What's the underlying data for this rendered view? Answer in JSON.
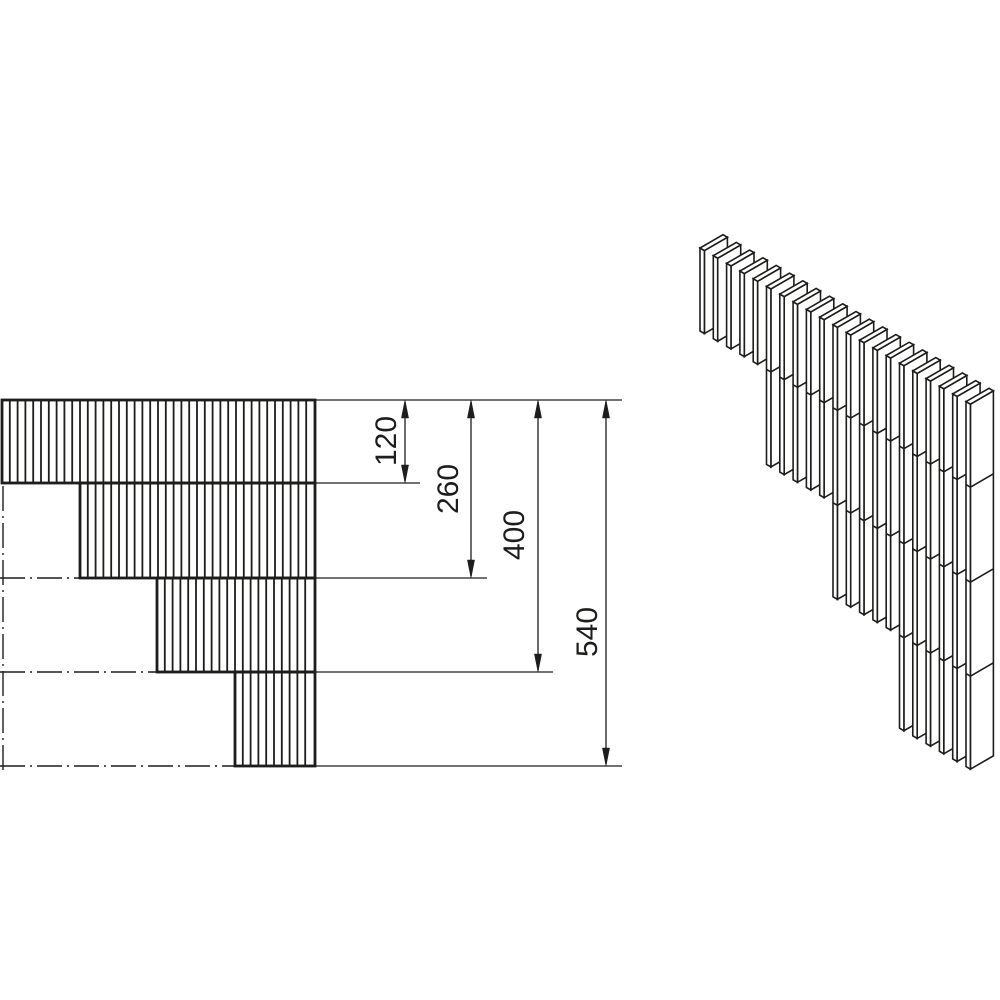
{
  "page": {
    "background": "#ffffff"
  },
  "drawing": {
    "type": "technical-drawing-stepped-lamella-corner",
    "stroke_color": "#1d1d1b",
    "fill_color": "#ffffff",
    "dimensions": {
      "labels": [
        "120",
        "260",
        "400",
        "540"
      ],
      "values": [
        120,
        260,
        400,
        540
      ],
      "font_size": 30,
      "lines": [
        {
          "x": 405,
          "y1": 400,
          "y2": 483,
          "label_x": 388,
          "label_y": 441
        },
        {
          "x": 471,
          "y1": 400,
          "y2": 578,
          "label_x": 450,
          "label_y": 489
        },
        {
          "x": 538,
          "y1": 400,
          "y2": 672,
          "label_x": 516,
          "label_y": 535
        },
        {
          "x": 606,
          "y1": 400,
          "y2": 766,
          "label_x": 589,
          "label_y": 632
        }
      ],
      "extension_lines": [
        [
          316,
          400,
          622,
          400
        ],
        [
          316,
          483,
          420,
          483
        ],
        [
          316,
          578,
          487,
          578
        ],
        [
          316,
          672,
          553,
          672
        ],
        [
          316,
          766,
          622,
          766
        ]
      ],
      "arrow_length": 18,
      "arrow_half_width": 3.6
    },
    "front_view": {
      "bands": [
        {
          "x": 2,
          "y": 400,
          "w": 313,
          "h": 83
        },
        {
          "x": 80,
          "y": 483,
          "w": 235,
          "h": 95
        },
        {
          "x": 157,
          "y": 578,
          "w": 158,
          "h": 94
        },
        {
          "x": 235,
          "y": 672,
          "w": 80,
          "h": 94
        }
      ],
      "hatch_spacing": 7.8,
      "hatch_width": 1.8,
      "border_width": 2.8,
      "centerlines": [
        [
          3,
          486,
          3,
          773
        ],
        [
          0,
          578,
          79,
          578
        ],
        [
          0,
          672,
          156,
          672
        ],
        [
          0,
          766,
          234,
          766
        ]
      ],
      "centerline_dash": "25 5 2 5",
      "centerline_width": 1.4
    },
    "iso_view": {
      "origin": [
        700,
        248
      ],
      "pitch": [
        13.3,
        7.68
      ],
      "thickness": [
        4.4,
        2.54
      ],
      "depth": [
        23,
        -13.28
      ],
      "group_sizes": [
        5,
        5,
        5,
        6
      ],
      "slat_heights": [
        83,
        178,
        272,
        365
      ],
      "joint_levels": [
        83,
        178,
        272
      ],
      "stroke_width": 1.6
    }
  }
}
